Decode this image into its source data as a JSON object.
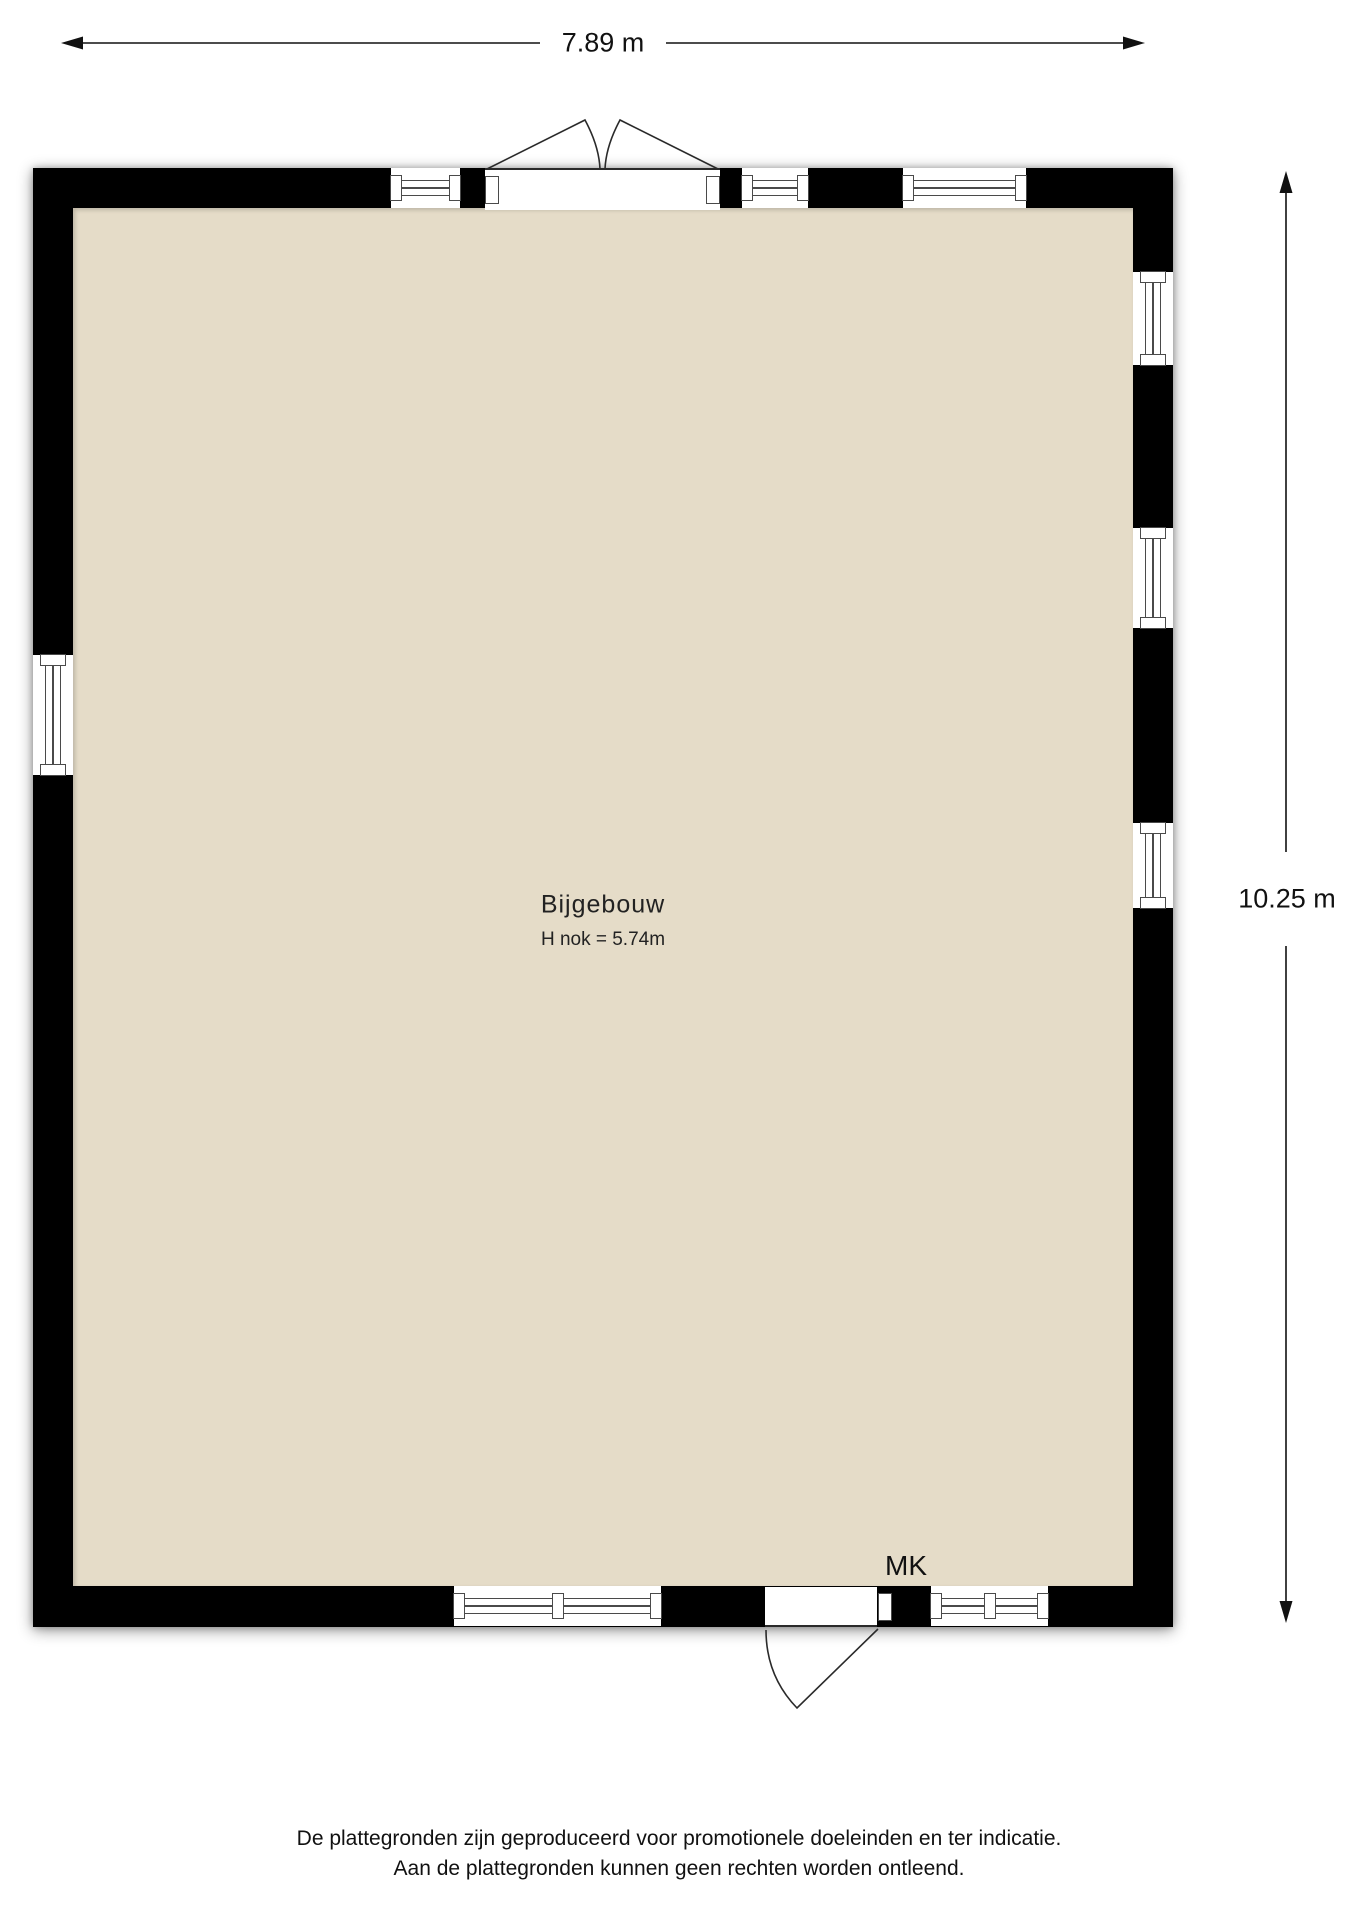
{
  "dimensions": {
    "width_label": "7.89 m",
    "height_label": "10.25 m"
  },
  "room": {
    "name": "Bijgebouw",
    "height_note": "H nok = 5.74m",
    "meter_closet_label": "MK"
  },
  "disclaimer": {
    "line1": "De plattegronden zijn geproduceerd voor promotionele doeleinden en ter indicatie.",
    "line2": "Aan de plattegronden kunnen geen rechten worden ontleend."
  },
  "colors": {
    "floor": "#e5dcc8",
    "wall": "#000000",
    "frame": "#4a4a4a"
  },
  "openings": {
    "top_wall": [
      "window",
      "double-door-outward",
      "window",
      "window"
    ],
    "right_wall": [
      "window",
      "window",
      "window"
    ],
    "bottom_wall": [
      "window",
      "door-outward",
      "window"
    ],
    "left_wall": [
      "window"
    ]
  }
}
